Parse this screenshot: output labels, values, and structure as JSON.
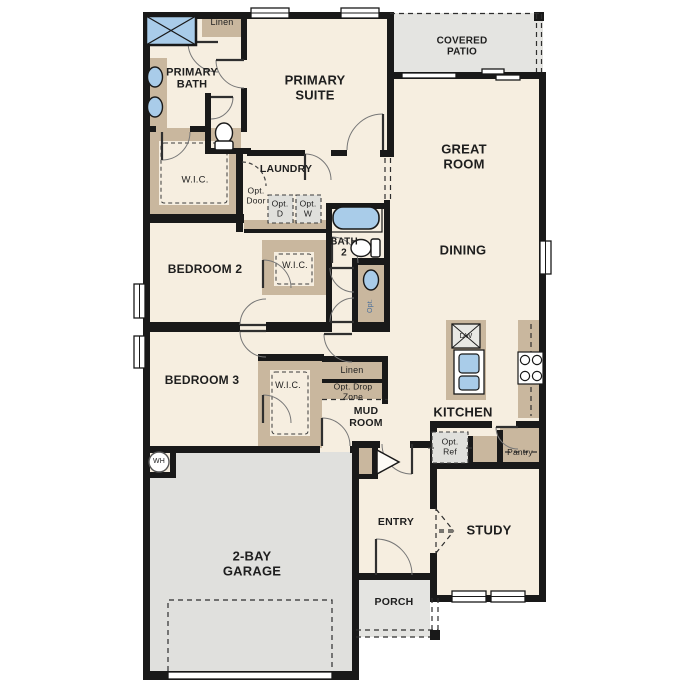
{
  "colors": {
    "floor": "#f6eee0",
    "outdoor_concrete": "#e4e4e1",
    "casework_tan": "#c9b79e",
    "fixture_blue": "#a9cce9",
    "appliance_gray": "#e0e0dc",
    "wall_black": "#191919",
    "label_text": "#1e1e1e"
  },
  "rooms": {
    "primary_suite": "PRIMARY\nSUITE",
    "primary_bath": "PRIMARY\nBATH",
    "great_room": "GREAT\nROOM",
    "dining": "DINING",
    "kitchen": "KITCHEN",
    "laundry": "LAUNDRY",
    "bath2": "BATH\n2",
    "bedroom2": "BEDROOM 2",
    "bedroom3": "BEDROOM 3",
    "mud_room": "MUD\nROOM",
    "study": "STUDY",
    "entry": "ENTRY",
    "porch": "PORCH",
    "garage": "2-BAY\nGARAGE",
    "covered_patio": "COVERED\nPATIO"
  },
  "closets": {
    "wic_primary": "W.I.C.",
    "wic_bedroom2": "W.I.C.",
    "wic_bedroom3": "W.I.C.",
    "linen_primary": "Linen",
    "linen_hall": "Linen",
    "pantry": "Pantry"
  },
  "options": {
    "opt_door": "Opt.\nDoor",
    "opt_dryer": "Opt.\nD",
    "opt_washer": "Opt.\nW",
    "opt_drop_zone": "Opt. Drop\nZone",
    "opt_ref": "Opt.\nRef",
    "opt_sink": "Opt."
  },
  "fixtures": {
    "dishwasher": "DW",
    "water_heater": "WH",
    "icon_names": [
      "shower-icon",
      "vanity-sink-icon",
      "toilet-icon",
      "bathtub-icon",
      "island-sink-icon",
      "dishwasher-icon",
      "cooktop-icon",
      "water-heater-icon",
      "window-icon",
      "door-swing-icon",
      "garage-door-icon"
    ]
  }
}
